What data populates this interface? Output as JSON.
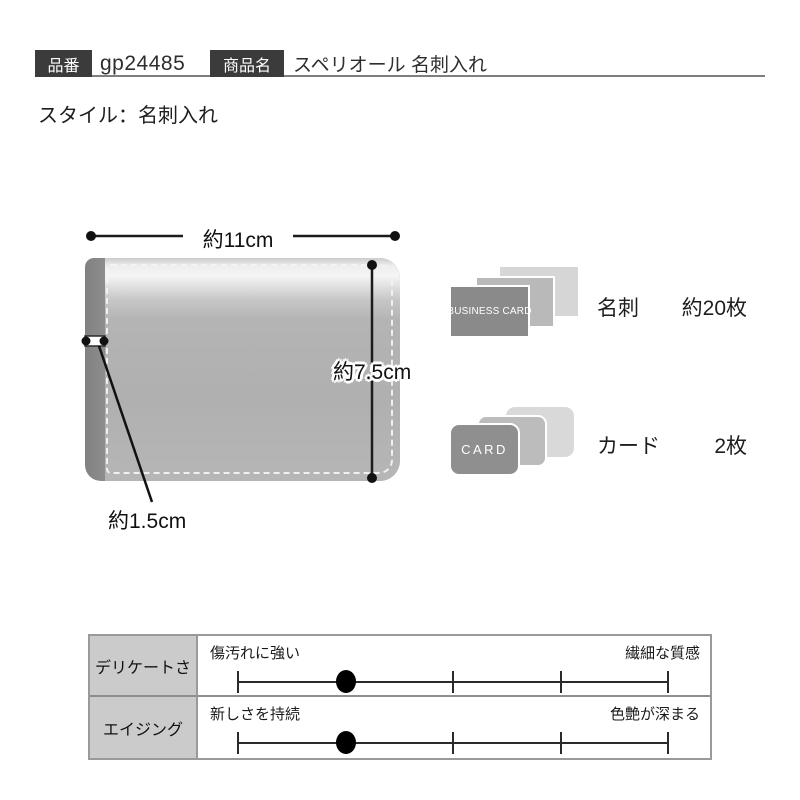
{
  "header": {
    "part_number_label": "品番",
    "part_number_value": "gp24485",
    "product_name_label": "商品名",
    "product_name_value": "スペリオール 名刺入れ",
    "tag_bg": "#3b3b3b",
    "underline_color": "#7e7e7e"
  },
  "style_line": "スタイル：名刺入れ",
  "diagram": {
    "width_label": "約11cm",
    "height_label": "約7.5cm",
    "thickness_label": "約1.5cm",
    "wallet_face_color": "#b2b2b2",
    "wallet_spine_color": "#8a8a8a",
    "stitch_color": "#f4f4f4",
    "line_color": "#1c1c1c"
  },
  "capacity": [
    {
      "front_text": "BUSINESS CARD",
      "label": "名刺",
      "count": "約20枚",
      "front_color": "#8a8a8a"
    },
    {
      "front_text": "CARD",
      "label": "カード",
      "count": "2枚",
      "front_color": "#8f8f8f"
    }
  ],
  "spec_table": {
    "border_color": "#9a9a9a",
    "label_bg": "#cbcbcb",
    "rows": [
      {
        "name": "デリケートさ",
        "left_label": "傷汚れに強い",
        "right_label": "繊細な質感",
        "value_percent": 25,
        "dot_style": "left: calc(25% - 10px)"
      },
      {
        "name": "エイジング",
        "left_label": "新しさを持続",
        "right_label": "色艶が深まる",
        "value_percent": 25,
        "dot_style": "left: calc(25% - 10px)"
      }
    ]
  }
}
